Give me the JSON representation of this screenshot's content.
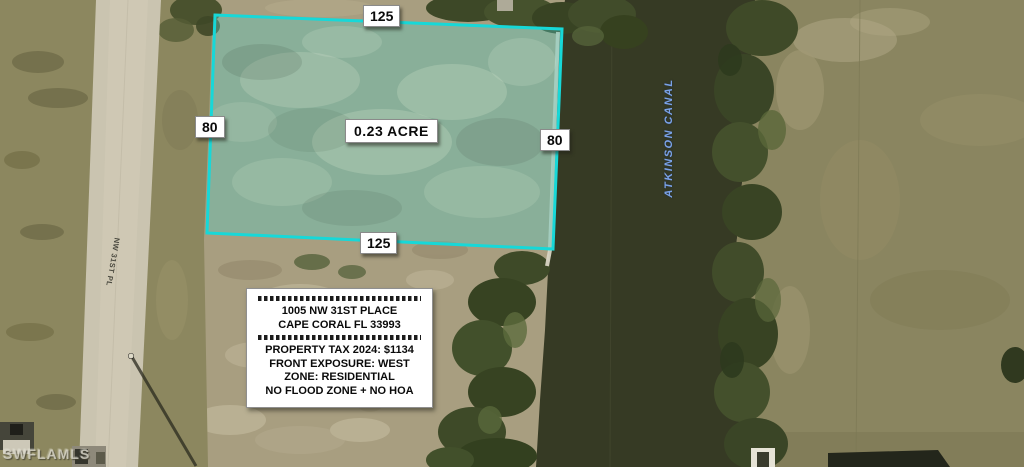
{
  "scene": {
    "description": "aerial satellite photo of vacant waterfront lot listing"
  },
  "lot": {
    "area": "0.23 ACRE",
    "dim_top": "125",
    "dim_left": "80",
    "dim_right": "80",
    "dim_bottom": "125"
  },
  "info_box": {
    "address_line1": "1005 NW 31ST PLACE",
    "address_line2": "CAPE CORAL FL 33993",
    "detail_lines": [
      "PROPERTY TAX 2024: $1134",
      "FRONT EXPOSURE: WEST",
      "ZONE: RESIDENTIAL",
      "NO FLOOD ZONE + NO HOA"
    ]
  },
  "map_labels": {
    "canal_name": "ATKINSON CANAL",
    "street_name": "NW 31ST PL",
    "watermark": "SWFLAMLS"
  },
  "colors": {
    "water": "#363a24",
    "dirt": "#a89e80",
    "grass": "#8c875f",
    "road": "#cac4b0",
    "lot_outline": "#17d8d8",
    "canal_label": "#7aa2e8"
  }
}
